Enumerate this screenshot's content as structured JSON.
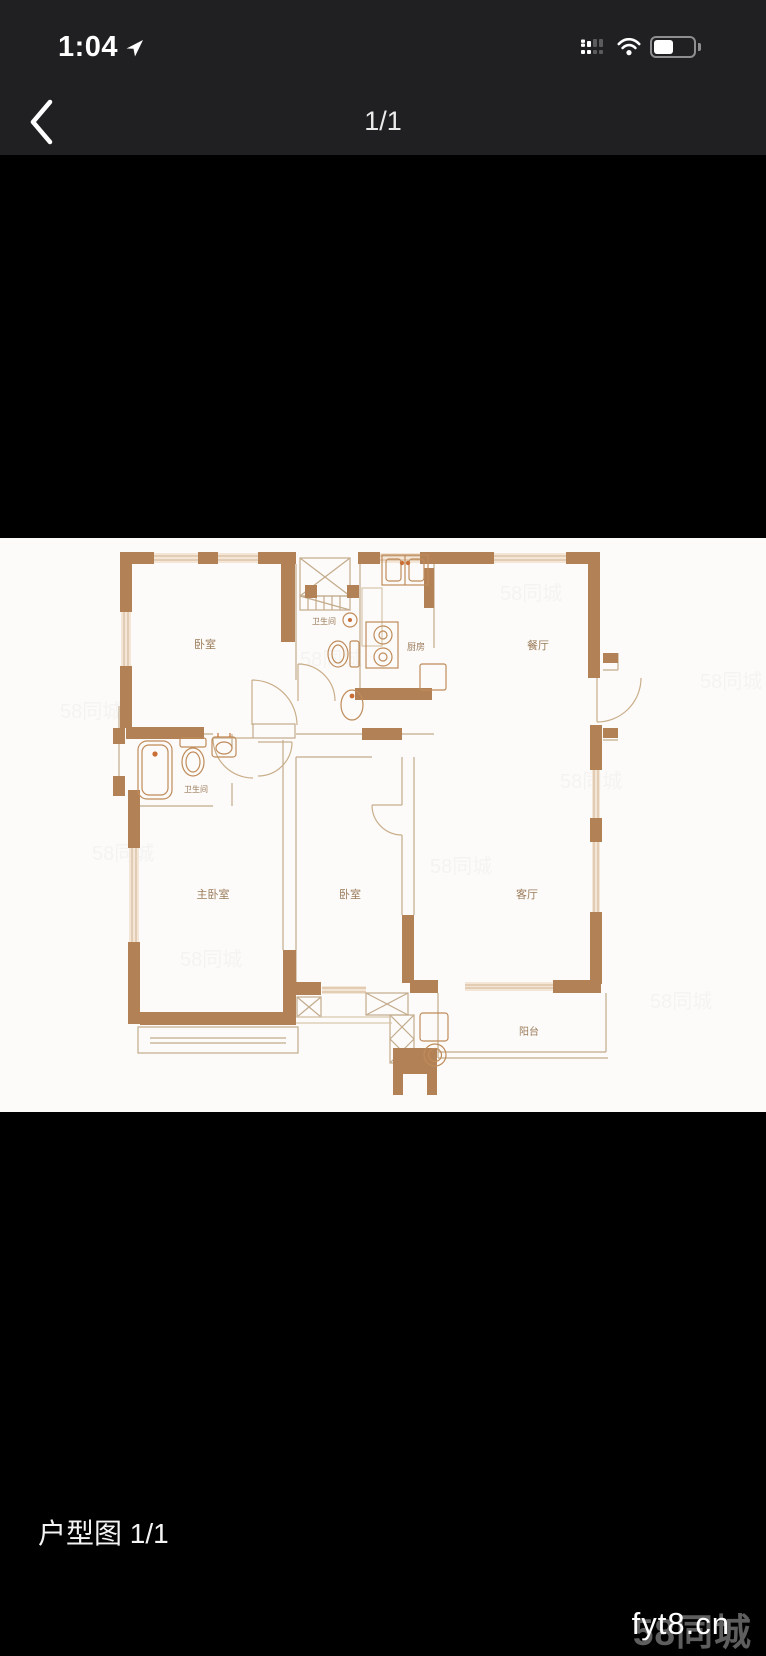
{
  "status_bar": {
    "time": "1:04",
    "location_icon": "navigation-arrow",
    "signal_icon": "dual-sim-cellular",
    "wifi_icon": "wifi",
    "battery_icon": "battery-half"
  },
  "nav_bar": {
    "back_icon": "chevron-left",
    "page_indicator": "1/1"
  },
  "photo": {
    "type": "floor-plan",
    "floor_plan": {
      "rooms": [
        {
          "id": "bedroom-top",
          "label": "卧室",
          "x": 205,
          "y": 110,
          "size": 11
        },
        {
          "id": "bath-top",
          "label": "卫生间",
          "x": 324,
          "y": 86,
          "size": 8
        },
        {
          "id": "kitchen",
          "label": "厨房",
          "x": 416,
          "y": 112,
          "size": 9
        },
        {
          "id": "dining",
          "label": "餐厅",
          "x": 538,
          "y": 111,
          "size": 11
        },
        {
          "id": "bath-left",
          "label": "卫生间",
          "x": 196,
          "y": 254,
          "size": 8
        },
        {
          "id": "master-bedroom",
          "label": "主卧室",
          "x": 213,
          "y": 360,
          "size": 11
        },
        {
          "id": "bedroom-mid",
          "label": "卧室",
          "x": 350,
          "y": 360,
          "size": 11
        },
        {
          "id": "living",
          "label": "客厅",
          "x": 527,
          "y": 360,
          "size": 11
        },
        {
          "id": "balcony",
          "label": "阳台",
          "x": 529,
          "y": 497,
          "size": 10
        }
      ],
      "faint_watermark_tile": "58同城"
    }
  },
  "caption": "户型图 1/1",
  "watermark": {
    "site": "fyt8.cn",
    "brand": "58同城"
  },
  "colors": {
    "chrome_bg": "#202022",
    "photo_bg": "#fcfbf9",
    "wall": "#b28155",
    "thin_line": "#c3ab8c",
    "window_fill": "#f4e6d6",
    "window_line": "#cfb293",
    "fixture": "#bf8b5a",
    "accent_orange": "#c96f35",
    "room_label": "#9b7b5a"
  }
}
